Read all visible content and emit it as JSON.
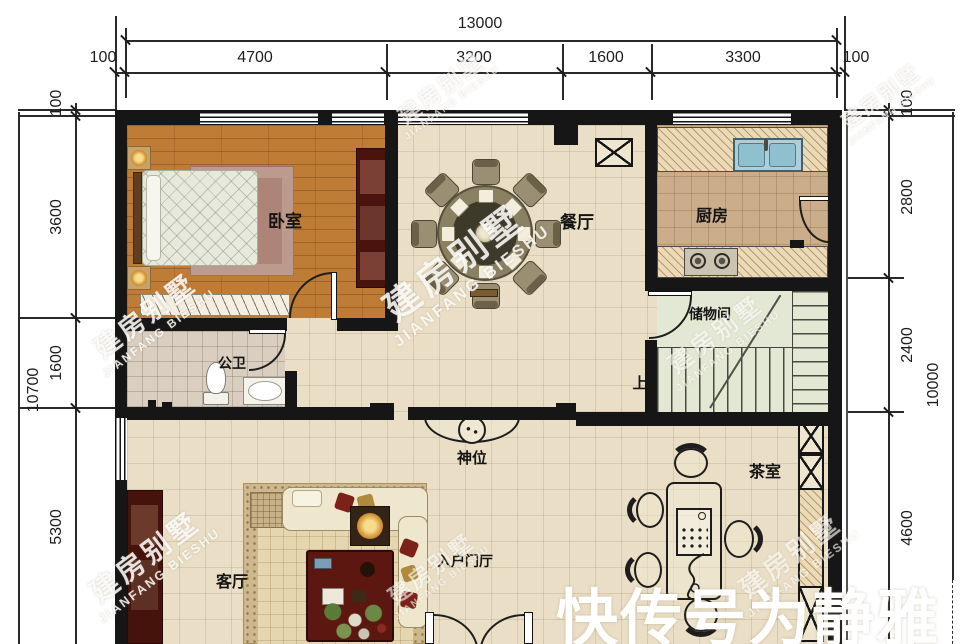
{
  "dims": {
    "top": {
      "total": "13000",
      "segments": [
        "100",
        "4700",
        "3200",
        "1600",
        "3300",
        "100"
      ]
    },
    "left": {
      "total": "10700",
      "segments": [
        "100",
        "3600",
        "1600",
        "5300"
      ]
    },
    "right": {
      "total": "10000",
      "segments": [
        "100",
        "2800",
        "2400",
        "4600"
      ]
    }
  },
  "rooms": {
    "bedroom": "卧室",
    "dining": "餐厅",
    "kitchen": "厨房",
    "bathroom": "公卫",
    "storage": "储物间",
    "stairs_up": "上",
    "shrine": "神位",
    "living": "客厅",
    "entry_hall": "入户门厅",
    "tea_room": "茶室"
  },
  "watermarks": {
    "brand_cn": "建房别墅",
    "brand_en": "JIANFANG BIESHU",
    "channel": "快传号为静雅"
  },
  "colors": {
    "wall": "#161616",
    "floor_main": "#eadfc6",
    "floor_bedroom": "#bf7c36",
    "floor_kitchen": "#cbad8b",
    "floor_bath": "#d9cec0",
    "floor_stairs": "#e3e8d5",
    "furniture_red": "#4a130d",
    "sink_blue": "#adcfdb"
  }
}
